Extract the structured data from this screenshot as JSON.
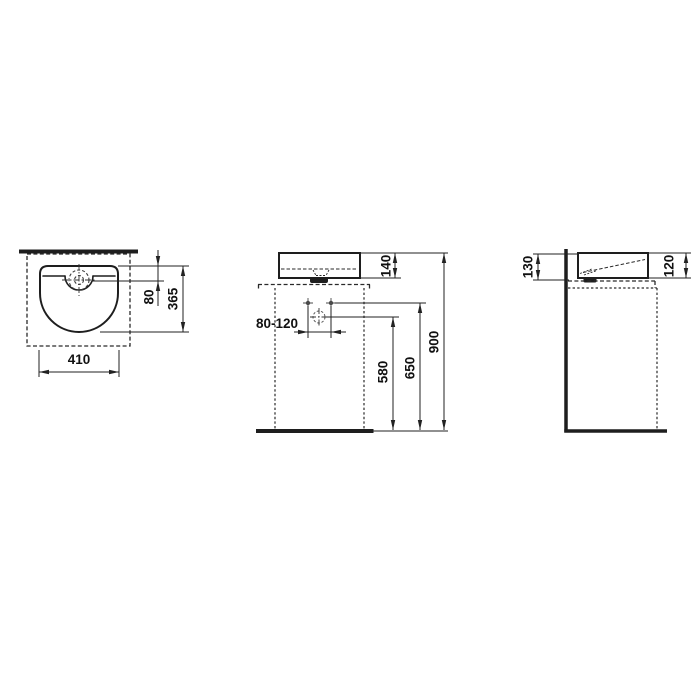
{
  "colors": {
    "line": "#1e1e1e",
    "background": "#ffffff"
  },
  "views": {
    "top": {
      "labels": {
        "offset": "80",
        "depth": "365",
        "width": "410"
      }
    },
    "front": {
      "labels": {
        "basin_height": "140",
        "spacing": "80-120",
        "drain_height": "580",
        "holes_height": "650",
        "total_height": "900"
      }
    },
    "side": {
      "labels": {
        "back_height": "130",
        "front_height": "120"
      }
    }
  }
}
